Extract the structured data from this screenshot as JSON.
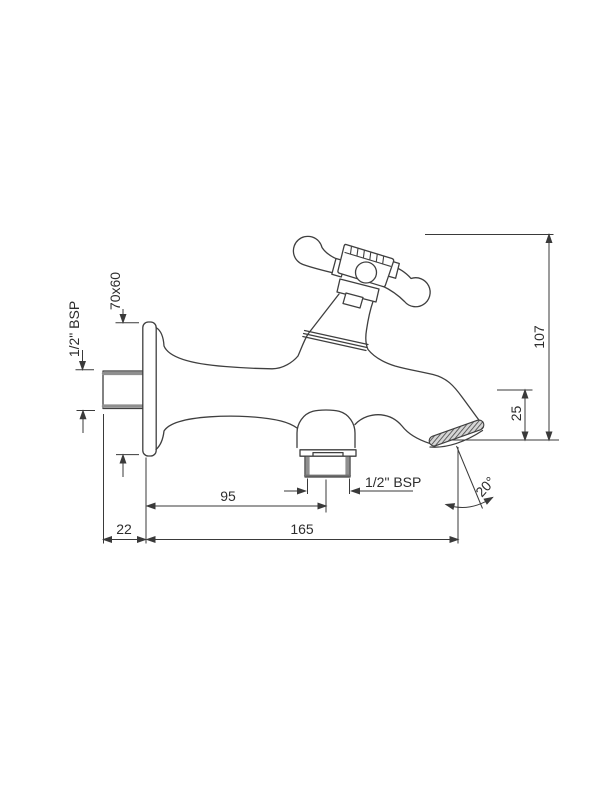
{
  "drawing": {
    "type": "technical-dimension-drawing",
    "subject": "wall-mounted-bib-tap-with-cross-handle",
    "labels": {
      "inlet_thread": "1/2\" BSP",
      "flange_size": "70x60",
      "overall_height": "107",
      "tip_drop": "25",
      "wall_to_outlet": "95",
      "wall_to_tip": "165",
      "nipple_length": "22",
      "outlet_thread": "1/2\" BSP",
      "spout_angle": "20°"
    },
    "colors": {
      "line": "#3f3f3f",
      "dimension": "#3a3a3a",
      "text": "#2d2d2d",
      "thread": "#8f8f8f",
      "background": "#ffffff"
    }
  }
}
